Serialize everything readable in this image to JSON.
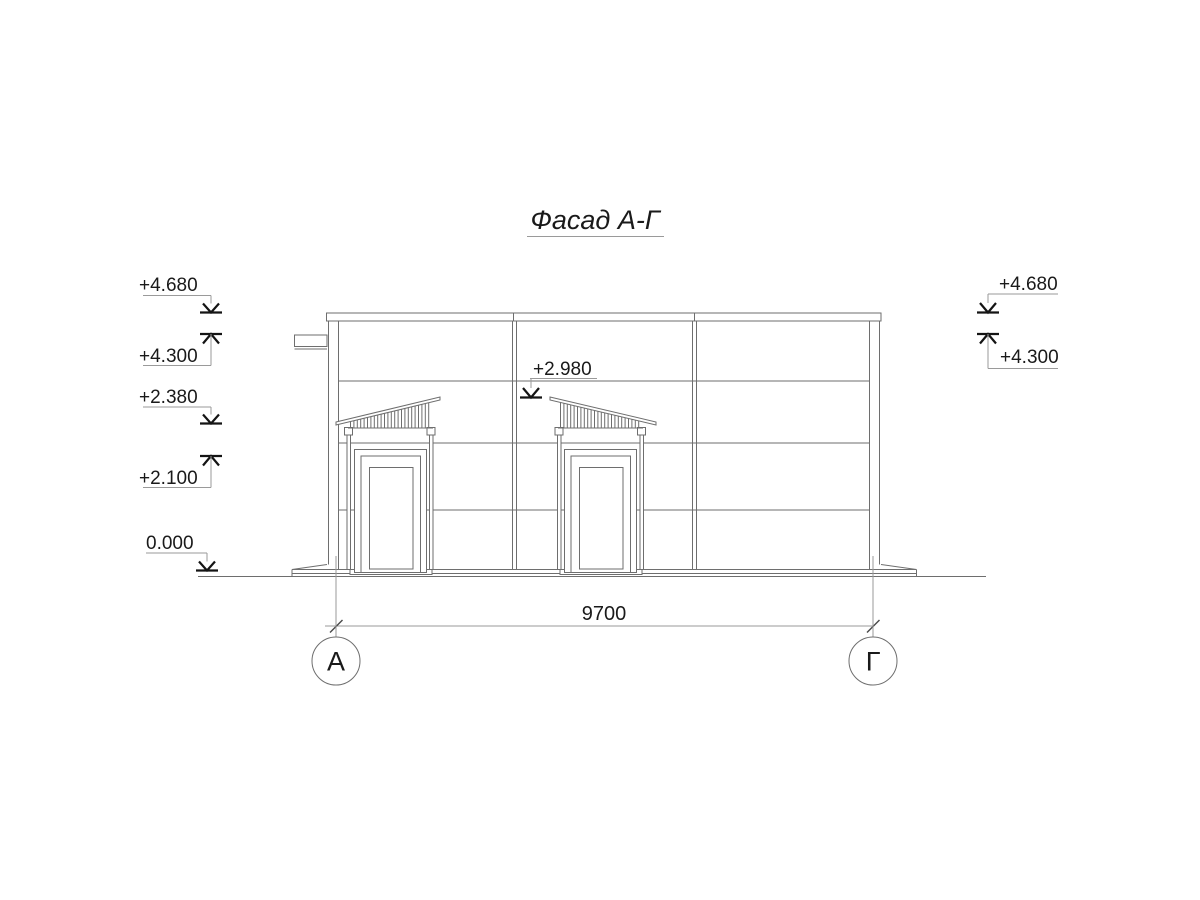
{
  "title": "Фасад А-Г",
  "elevation_marks": {
    "left": [
      {
        "value": "+4.680",
        "direction": "down"
      },
      {
        "value": "+4.300",
        "direction": "up"
      },
      {
        "value": "+2.380",
        "direction": "down"
      },
      {
        "value": "+2.100",
        "direction": "up"
      },
      {
        "value": "0.000",
        "direction": "down"
      }
    ],
    "middle": [
      {
        "value": "+2.980",
        "direction": "down"
      }
    ],
    "right": [
      {
        "value": "+4.680",
        "direction": "down"
      },
      {
        "value": "+4.300",
        "direction": "up"
      }
    ]
  },
  "dimensions": [
    {
      "value": "9700"
    }
  ],
  "axes": [
    {
      "label": "А"
    },
    {
      "label": "Г"
    }
  ],
  "colors": {
    "background": "#ffffff",
    "drawing_line": "#6e6e6e",
    "leader_line": "#9a9a9a",
    "text": "#1a1a1a",
    "mark_arrow": "#141414"
  }
}
